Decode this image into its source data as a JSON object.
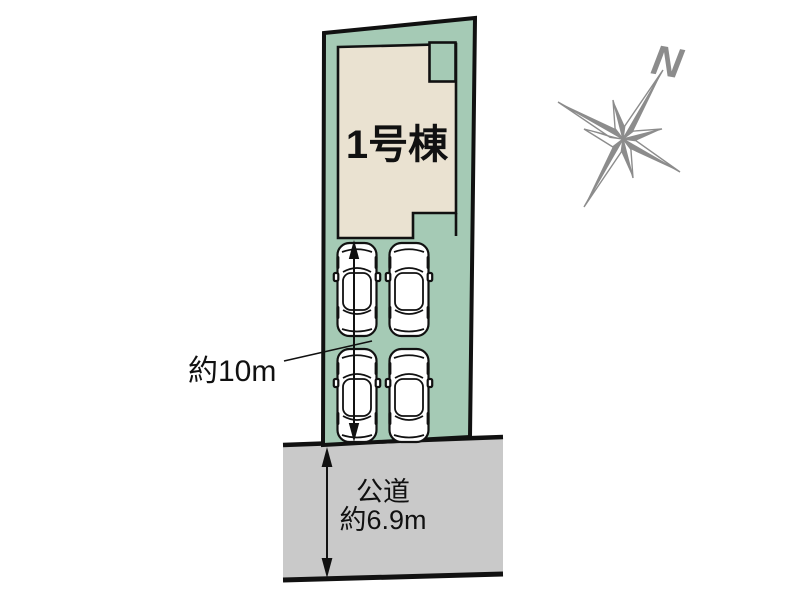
{
  "labels": {
    "building": "1号棟",
    "depth": "約10m",
    "road_type": "公道",
    "road_width": "約6.9m",
    "compass_north": "N"
  },
  "colors": {
    "parcel": "#a5cab5",
    "building": "#eae2d1",
    "road": "#c9c9c9",
    "outline": "#111111",
    "compass": "#8c8c8c",
    "car_body": "#ffffff"
  }
}
